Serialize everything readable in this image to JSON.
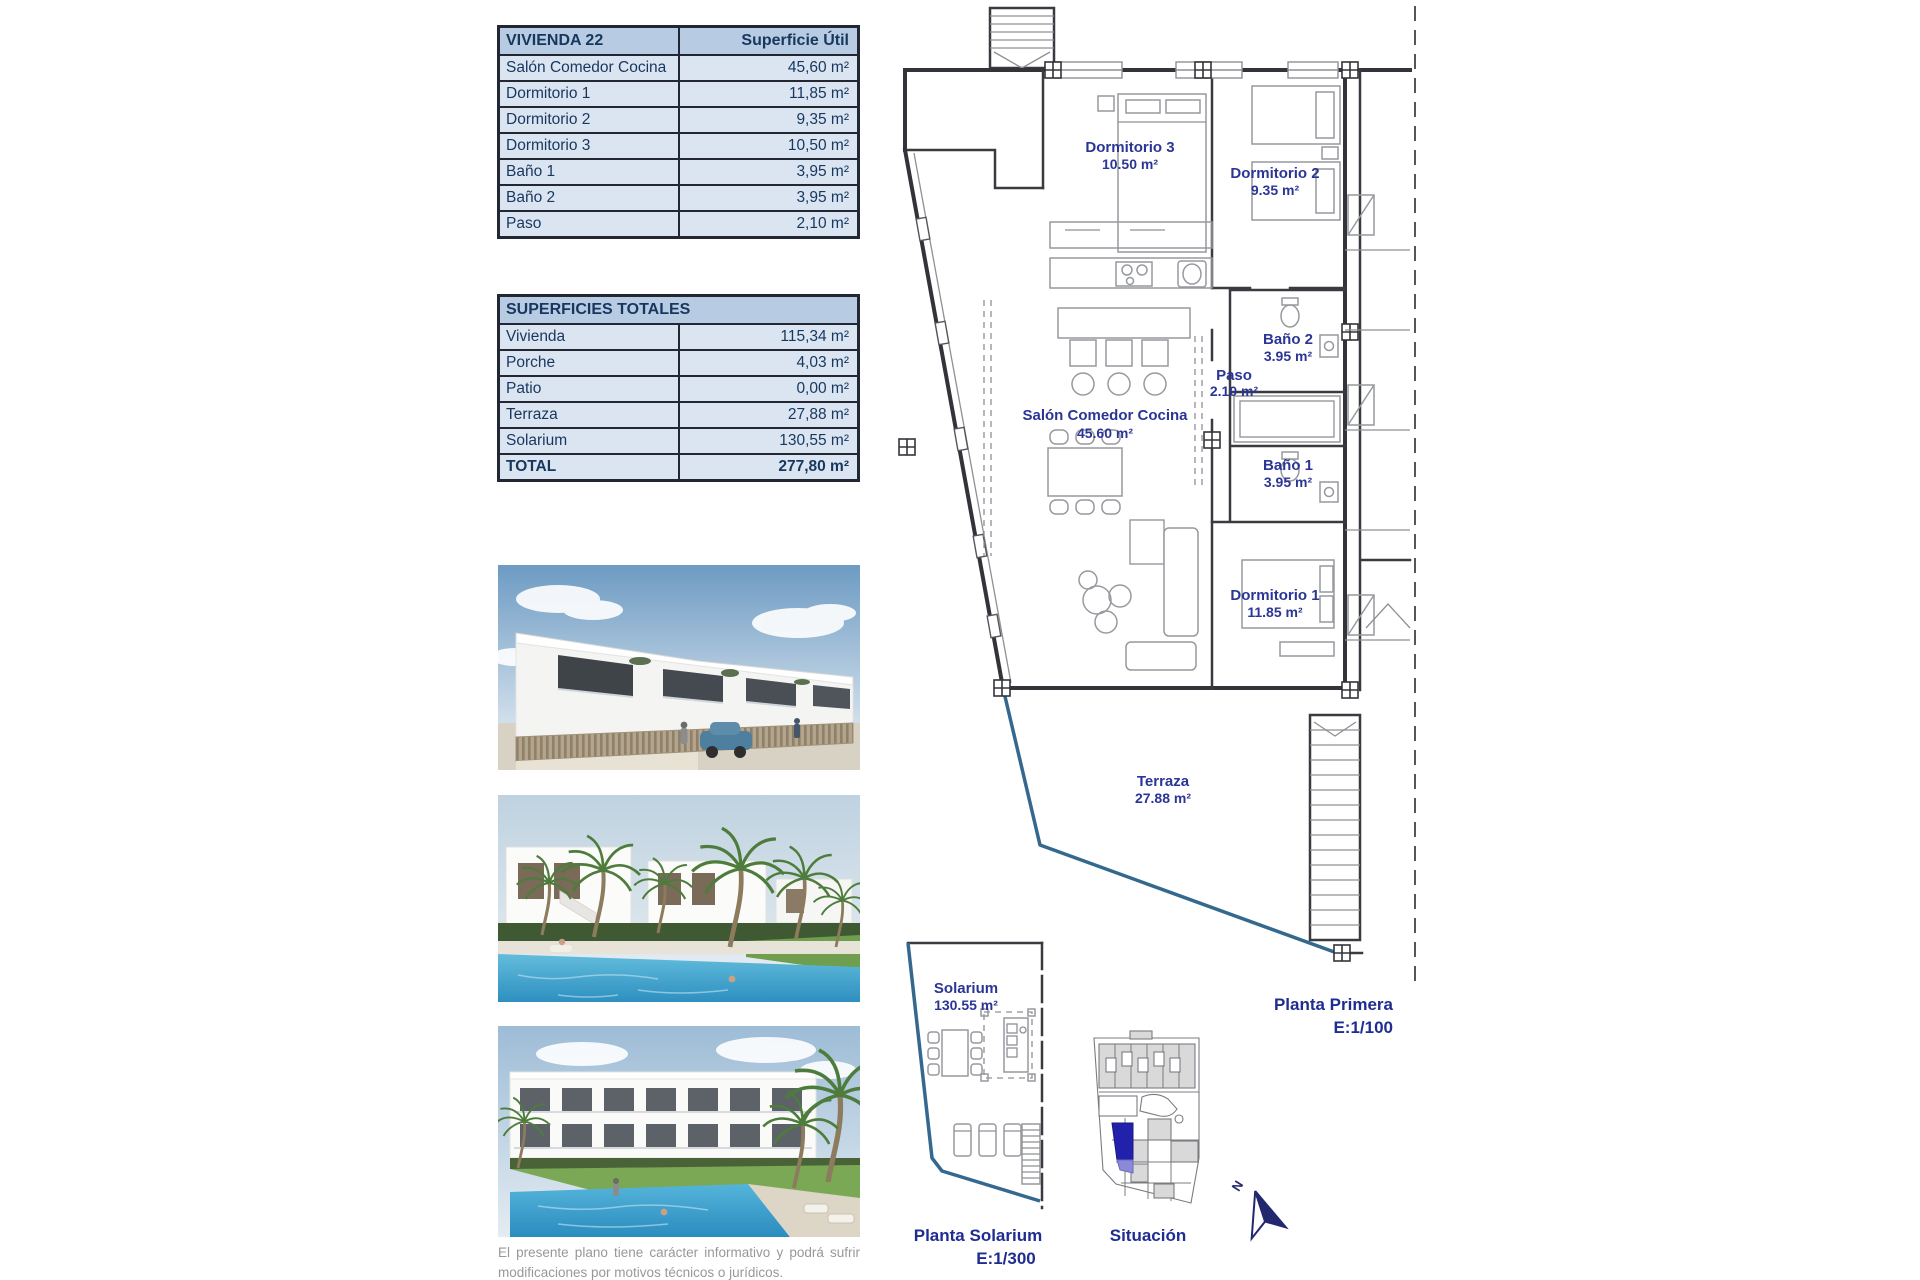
{
  "document": {
    "disclaimer": "El presente plano tiene carácter informativo y podrá sufrir modificaciones por motivos técnicos o jurídicos."
  },
  "unit_table": {
    "title": "VIVIENDA 22",
    "value_header": "Superficie Útil",
    "rows": [
      {
        "label": "Salón Comedor Cocina",
        "value": "45,60 m²"
      },
      {
        "label": "Dormitorio 1",
        "value": "11,85 m²"
      },
      {
        "label": "Dormitorio 2",
        "value": "9,35 m²"
      },
      {
        "label": "Dormitorio 3",
        "value": "10,50 m²"
      },
      {
        "label": "Baño 1",
        "value": "3,95 m²"
      },
      {
        "label": "Baño 2",
        "value": "3,95 m²"
      },
      {
        "label": "Paso",
        "value": "2,10 m²"
      }
    ]
  },
  "totals_table": {
    "title": "SUPERFICIES TOTALES",
    "rows": [
      {
        "label": "Vivienda",
        "value": "115,34 m²"
      },
      {
        "label": "Porche",
        "value": "4,03 m²"
      },
      {
        "label": "Patio",
        "value": "0,00 m²"
      },
      {
        "label": "Terraza",
        "value": "27,88 m²"
      },
      {
        "label": "Solarium",
        "value": "130,55 m²"
      }
    ],
    "total_row": {
      "label": "TOTAL",
      "value": "277,80 m²"
    }
  },
  "floor_plan": {
    "caption_title": "Planta Primera",
    "caption_scale": "E:1/100",
    "rooms": {
      "dormitorio3": {
        "name": "Dormitorio 3",
        "area": "10.50 m²"
      },
      "dormitorio2": {
        "name": "Dormitorio 2",
        "area": "9.35 m²"
      },
      "bano2": {
        "name": "Baño 2",
        "area": "3.95 m²"
      },
      "paso": {
        "name": "Paso",
        "area": "2.10 m²"
      },
      "salon": {
        "name": "Salón Comedor Cocina",
        "area": "45.60 m²"
      },
      "bano1": {
        "name": "Baño 1",
        "area": "3.95 m²"
      },
      "dormitorio1": {
        "name": "Dormitorio 1",
        "area": "11.85 m²"
      },
      "terraza": {
        "name": "Terraza",
        "area": "27.88 m²"
      }
    }
  },
  "solarium_plan": {
    "room": {
      "name": "Solarium",
      "area": "130.55 m²"
    },
    "caption_title": "Planta Solarium",
    "caption_scale": "E:1/300"
  },
  "situation_plan": {
    "caption": "Situación",
    "north_label": "N",
    "highlight_color": "#2121AC"
  },
  "colors": {
    "table_text": "#17375E",
    "table_header_bg": "#B7CBE2",
    "table_row_bg": "#DBE5F1",
    "plan_label": "#2B3596",
    "boundary_blue": "#35688E"
  }
}
